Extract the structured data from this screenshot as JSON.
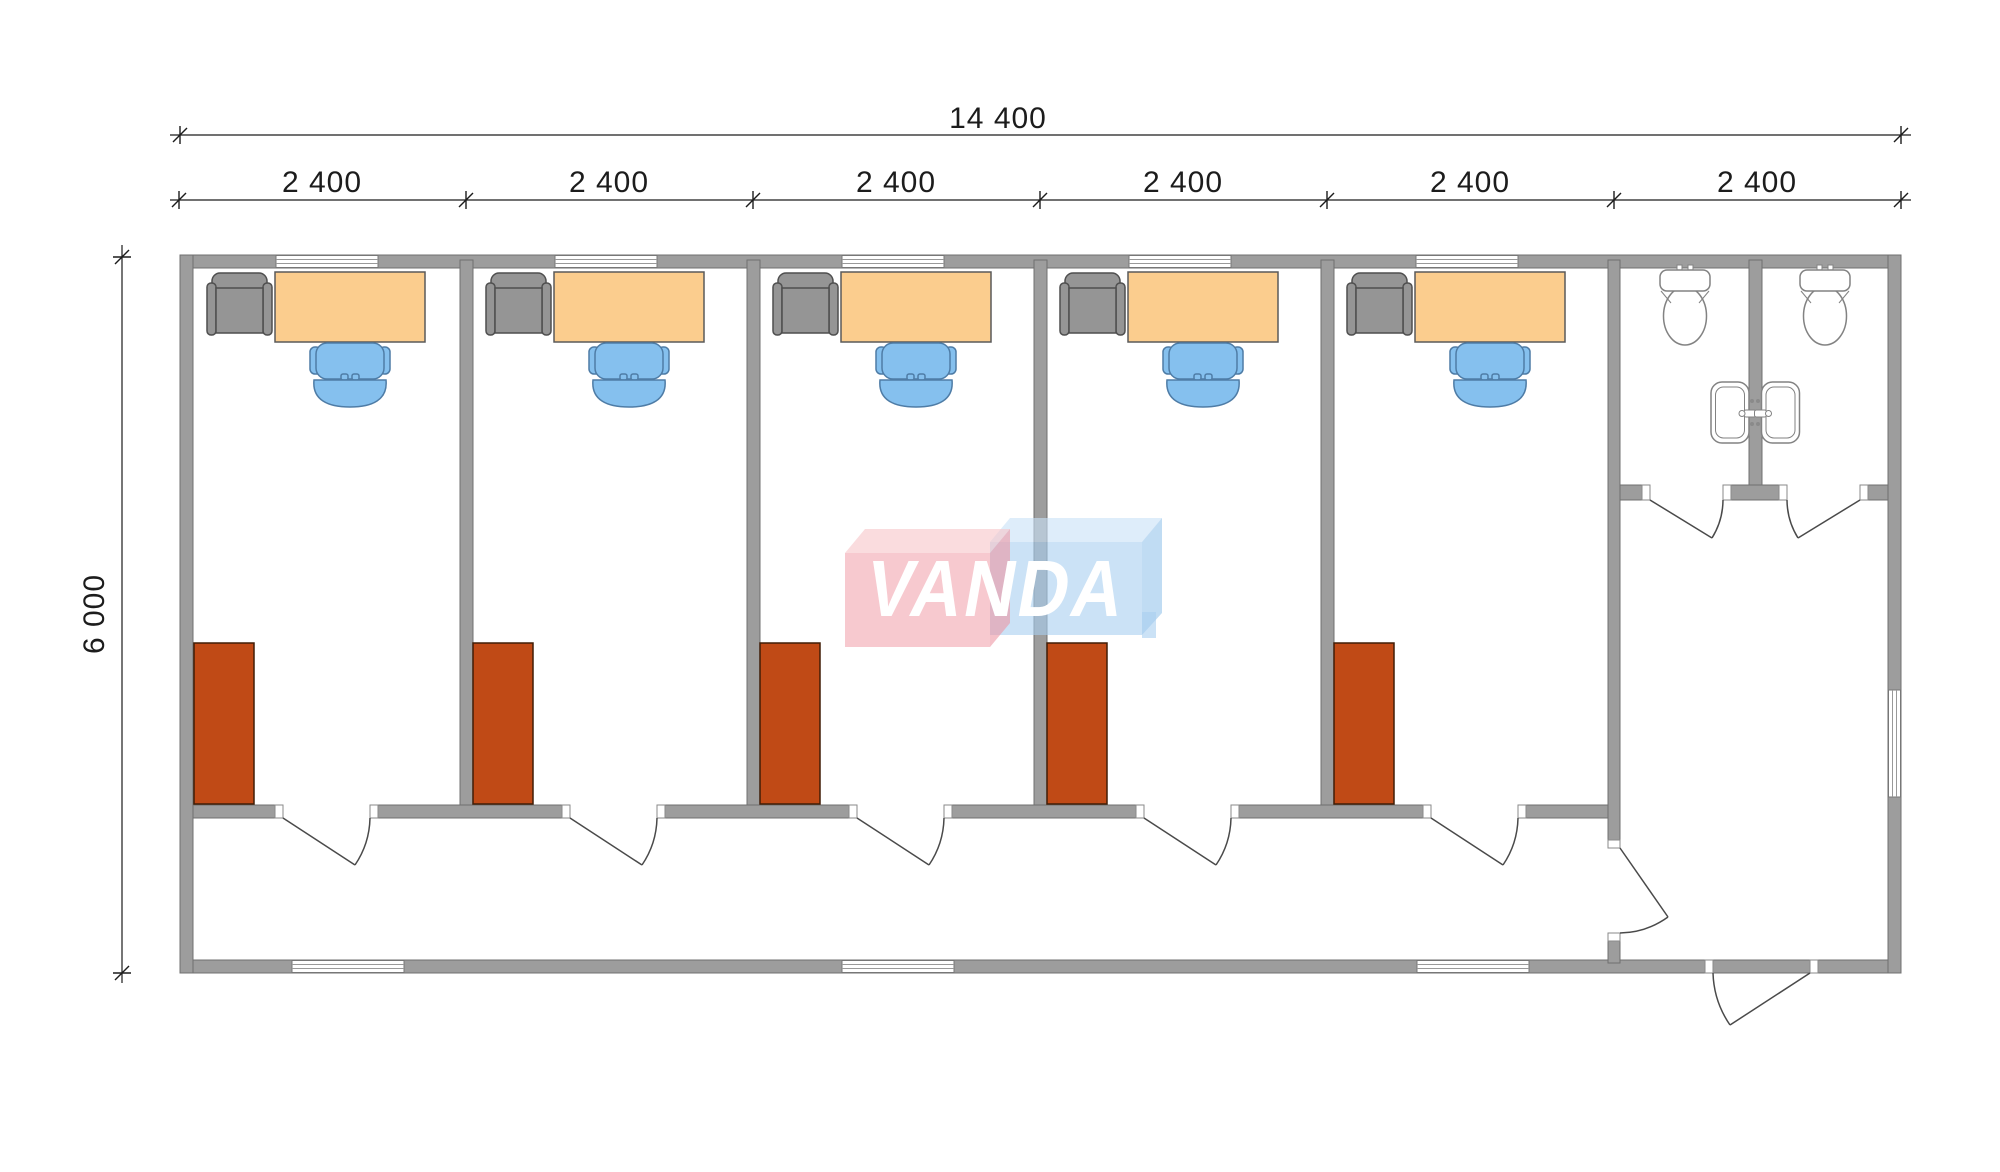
{
  "dimensions": {
    "overall_width": "14 400",
    "bays": [
      "2 400",
      "2 400",
      "2 400",
      "2 400",
      "2 400",
      "2 400"
    ],
    "overall_depth": "6 000"
  },
  "logo": {
    "text": "VANDA",
    "pink_face": "#f2c7cd",
    "blue_face": "#c8e0f4"
  },
  "colors": {
    "wall_fill": "#9d9d9d",
    "wall_outline": "#707070",
    "desk_fill": "#fbcd8e",
    "task_chair_fill": "#85c0ee",
    "task_chair_outline": "#4e7ca6",
    "visitor_chair_fill": "#959595",
    "visitor_chair_outline": "#4f4f4f",
    "cabinet_fill": "#c04a16",
    "cabinet_outline": "#401d06",
    "fixture_outline": "#828282",
    "dimension_color": "#1c1c1c"
  }
}
